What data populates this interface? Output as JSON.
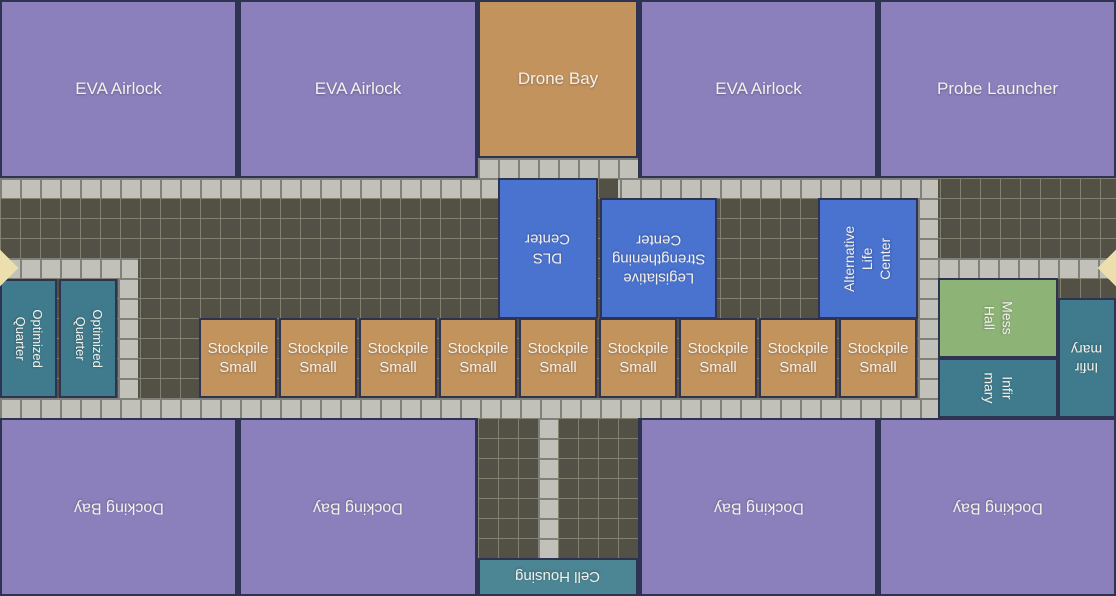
{
  "map": {
    "width": 1116,
    "height": 596,
    "colors": {
      "divider": "#2d3350",
      "room_purple": "#8b80bc",
      "room_tan": "#c3935e",
      "room_blue": "#4a73d0",
      "room_green": "#8db377",
      "room_teal": "#3f7b8c",
      "room_teal_light": "#4c8593",
      "tile_light": "#c2c1b9",
      "tile_light_line": "#80807a",
      "tile_dark": "#535145",
      "tile_dark_line": "#82806f",
      "door_diamond": "#ecdfad",
      "label_text": "#f3f1ea"
    },
    "tile_regions": [
      {
        "name": "corridor-main-floor",
        "type": "dark",
        "x": 0,
        "y": 178,
        "w": 1116,
        "h": 240
      },
      {
        "name": "corridor-south-floor",
        "type": "dark",
        "x": 478,
        "y": 418,
        "w": 160,
        "h": 140
      },
      {
        "name": "walkway-top",
        "type": "light",
        "x": 0,
        "y": 178,
        "w": 938,
        "h": 20
      },
      {
        "name": "walkway-bottom",
        "type": "light",
        "x": 0,
        "y": 398,
        "w": 938,
        "h": 20
      },
      {
        "name": "walkway-drone-bay",
        "type": "light",
        "x": 478,
        "y": 158,
        "w": 160,
        "h": 20
      },
      {
        "name": "walkway-left-branch",
        "type": "light",
        "x": 0,
        "y": 258,
        "w": 138,
        "h": 20
      },
      {
        "name": "walkway-left-column",
        "type": "light",
        "x": 118,
        "y": 278,
        "w": 20,
        "h": 120
      },
      {
        "name": "walkway-right-column",
        "type": "light",
        "x": 918,
        "y": 198,
        "w": 20,
        "h": 200
      },
      {
        "name": "walkway-right-branch",
        "type": "light",
        "x": 938,
        "y": 258,
        "w": 178,
        "h": 20
      },
      {
        "name": "walkway-south-column",
        "type": "light",
        "x": 538,
        "y": 418,
        "w": 20,
        "h": 140
      },
      {
        "name": "floor-patch-dark",
        "type": "dark",
        "x": 598,
        "y": 178,
        "w": 20,
        "h": 20
      }
    ],
    "rooms": [
      {
        "name": "eva-airlock-1",
        "label": "EVA Airlock",
        "x": 0,
        "y": 0,
        "w": 237,
        "h": 178,
        "color": "purple",
        "rotate": 0,
        "font": 17
      },
      {
        "name": "eva-airlock-2",
        "label": "EVA Airlock",
        "x": 239,
        "y": 0,
        "w": 238,
        "h": 178,
        "color": "purple",
        "rotate": 0,
        "font": 17
      },
      {
        "name": "drone-bay",
        "label": "Drone Bay",
        "x": 478,
        "y": 0,
        "w": 160,
        "h": 158,
        "color": "tan",
        "rotate": 0,
        "font": 17
      },
      {
        "name": "eva-airlock-3",
        "label": "EVA Airlock",
        "x": 640,
        "y": 0,
        "w": 237,
        "h": 178,
        "color": "purple",
        "rotate": 0,
        "font": 17
      },
      {
        "name": "probe-launcher",
        "label": "Probe Launcher",
        "x": 879,
        "y": 0,
        "w": 237,
        "h": 178,
        "color": "purple",
        "rotate": 0,
        "font": 17
      },
      {
        "name": "dls-center",
        "label": "DLS\nCenter",
        "x": 498,
        "y": 178,
        "w": 100,
        "h": 141,
        "color": "blue",
        "rotate": 180,
        "font": 15
      },
      {
        "name": "legislative-strengthening-center",
        "label": "Legislative\nStrengthening\nCenter",
        "x": 600,
        "y": 198,
        "w": 117,
        "h": 121,
        "color": "blue",
        "rotate": 180,
        "font": 15
      },
      {
        "name": "alternative-life-center",
        "label": "Alternative\nLife\nCenter",
        "x": 818,
        "y": 198,
        "w": 100,
        "h": 121,
        "color": "blue",
        "rotate": 270,
        "font": 14
      },
      {
        "name": "stockpile-small-1",
        "label": "Stockpile\nSmall",
        "x": 199,
        "y": 318,
        "w": 78,
        "h": 80,
        "color": "tan",
        "rotate": 0,
        "font": 15
      },
      {
        "name": "stockpile-small-2",
        "label": "Stockpile\nSmall",
        "x": 279,
        "y": 318,
        "w": 78,
        "h": 80,
        "color": "tan",
        "rotate": 0,
        "font": 15
      },
      {
        "name": "stockpile-small-3",
        "label": "Stockpile\nSmall",
        "x": 359,
        "y": 318,
        "w": 78,
        "h": 80,
        "color": "tan",
        "rotate": 0,
        "font": 15
      },
      {
        "name": "stockpile-small-4",
        "label": "Stockpile\nSmall",
        "x": 439,
        "y": 318,
        "w": 78,
        "h": 80,
        "color": "tan",
        "rotate": 0,
        "font": 15
      },
      {
        "name": "stockpile-small-5",
        "label": "Stockpile\nSmall",
        "x": 519,
        "y": 318,
        "w": 78,
        "h": 80,
        "color": "tan",
        "rotate": 0,
        "font": 15
      },
      {
        "name": "stockpile-small-6",
        "label": "Stockpile\nSmall",
        "x": 599,
        "y": 318,
        "w": 78,
        "h": 80,
        "color": "tan",
        "rotate": 0,
        "font": 15
      },
      {
        "name": "stockpile-small-7",
        "label": "Stockpile\nSmall",
        "x": 679,
        "y": 318,
        "w": 78,
        "h": 80,
        "color": "tan",
        "rotate": 0,
        "font": 15
      },
      {
        "name": "stockpile-small-8",
        "label": "Stockpile\nSmall",
        "x": 759,
        "y": 318,
        "w": 78,
        "h": 80,
        "color": "tan",
        "rotate": 0,
        "font": 15
      },
      {
        "name": "stockpile-small-9",
        "label": "Stockpile\nSmall",
        "x": 839,
        "y": 318,
        "w": 78,
        "h": 80,
        "color": "tan",
        "rotate": 0,
        "font": 15
      },
      {
        "name": "optimized-quarter-1",
        "label": "Optimized\nQuarter",
        "x": 0,
        "y": 279,
        "w": 57,
        "h": 119,
        "color": "teal",
        "rotate": 90,
        "font": 13
      },
      {
        "name": "optimized-quarter-2",
        "label": "Optimized\nQuarter",
        "x": 59,
        "y": 279,
        "w": 58,
        "h": 119,
        "color": "teal",
        "rotate": 90,
        "font": 13
      },
      {
        "name": "mess-hall",
        "label": "Mess\nHall",
        "x": 938,
        "y": 278,
        "w": 120,
        "h": 80,
        "color": "green",
        "rotate": 90,
        "font": 14
      },
      {
        "name": "infirmary-1",
        "label": "Infir\nmary",
        "x": 938,
        "y": 358,
        "w": 120,
        "h": 60,
        "color": "teal",
        "rotate": 90,
        "font": 14
      },
      {
        "name": "infirmary-2",
        "label": "Infir\nmary",
        "x": 1058,
        "y": 298,
        "w": 58,
        "h": 120,
        "color": "teal",
        "rotate": 180,
        "font": 14
      },
      {
        "name": "docking-bay-1",
        "label": "Docking Bay",
        "x": 0,
        "y": 418,
        "w": 237,
        "h": 178,
        "color": "purple",
        "rotate": 180,
        "font": 16
      },
      {
        "name": "docking-bay-2",
        "label": "Docking Bay",
        "x": 239,
        "y": 418,
        "w": 238,
        "h": 178,
        "color": "purple",
        "rotate": 180,
        "font": 16
      },
      {
        "name": "docking-bay-3",
        "label": "Docking Bay",
        "x": 640,
        "y": 418,
        "w": 237,
        "h": 178,
        "color": "purple",
        "rotate": 180,
        "font": 16
      },
      {
        "name": "docking-bay-4",
        "label": "Docking Bay",
        "x": 879,
        "y": 418,
        "w": 237,
        "h": 178,
        "color": "purple",
        "rotate": 180,
        "font": 16
      },
      {
        "name": "cell-housing",
        "label": "Cell Housing",
        "x": 478,
        "y": 558,
        "w": 160,
        "h": 38,
        "color": "teal_light",
        "rotate": 180,
        "font": 15
      }
    ],
    "doors": [
      {
        "name": "docking-arrow-left",
        "x": 0,
        "y": 268
      },
      {
        "name": "docking-arrow-right",
        "x": 1116,
        "y": 268
      }
    ]
  }
}
